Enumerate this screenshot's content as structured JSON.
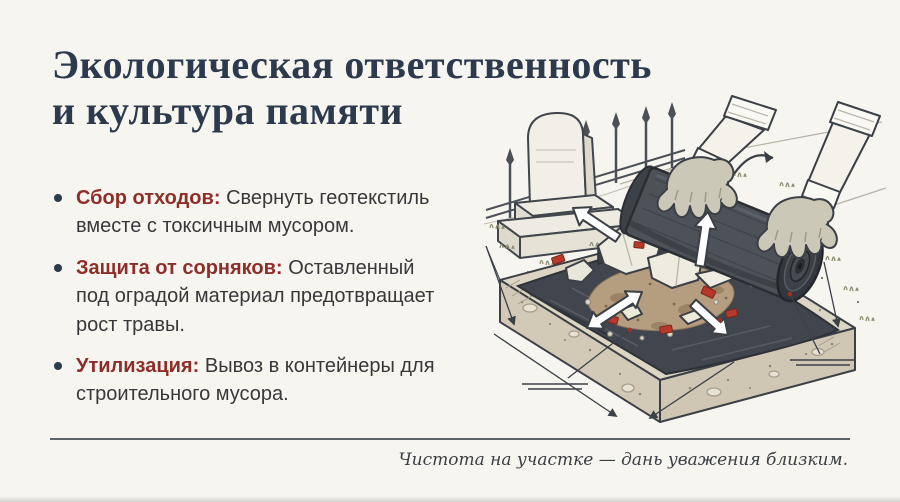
{
  "header": {
    "title_line1": "Экологическая ответственность",
    "title_line2": "и культура памяти"
  },
  "bullets": [
    {
      "label": "Сбор отходов:",
      "text": "Свернуть геотекстиль вместе с токсичным мусором."
    },
    {
      "label": "Защита от сорняков:",
      "text": "Оставленный под оградой материал предотвращает рост травы."
    },
    {
      "label": "Утилизация:",
      "text": "Вывоз в контейнеры для строительного мусора."
    }
  ],
  "footer": {
    "caption": "Чистота на участке — дань уважения близким."
  },
  "colors": {
    "background": "#f7f5ef",
    "title": "#2d3a4e",
    "accent_red": "#8e2e2a",
    "body_text": "#38383b",
    "divider": "#4a525b",
    "geotextile": "#41464e",
    "soil": "#d6cfbd",
    "debris_red": "#b7392c"
  },
  "illustration": {
    "elements": [
      "gravestone",
      "cemetery-fence",
      "gloved-hands",
      "geotextile-roll",
      "geotextile-sheet",
      "soil-cross-section",
      "construction-debris",
      "direction-arrows",
      "dimension-lines"
    ]
  }
}
